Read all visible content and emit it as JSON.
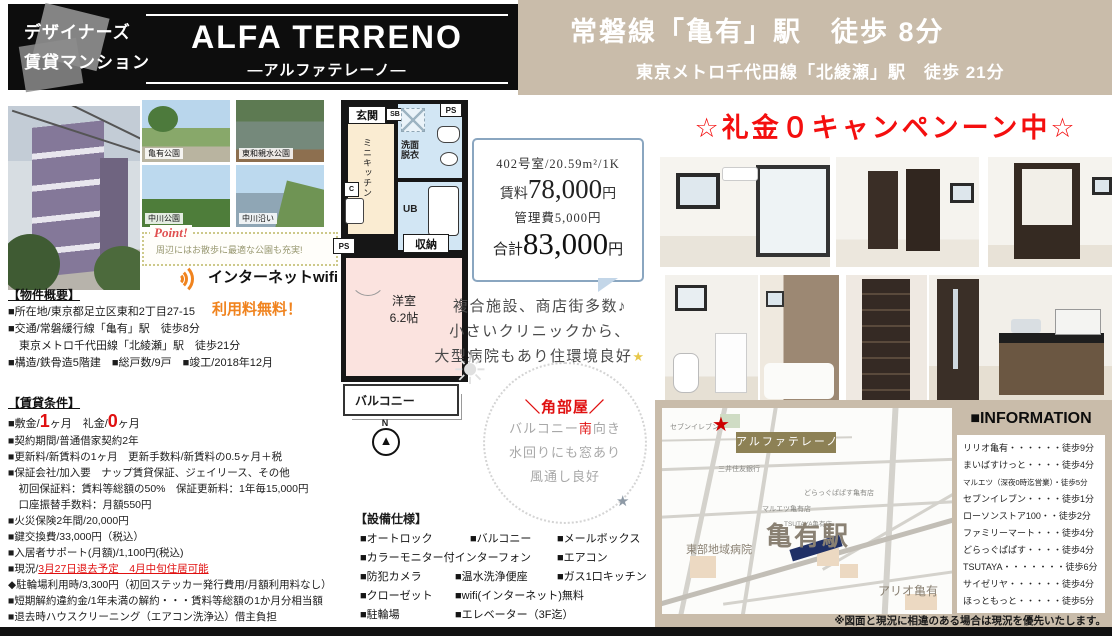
{
  "colors": {
    "accent_red": "#f40f0f",
    "orange": "#f0831e",
    "tan": "#c9bcaa",
    "navy": "#203066",
    "olive": "#8d8155"
  },
  "header": {
    "tagline1": "デザイナーズ",
    "tagline2": "賃貸マンション",
    "building_name": "ALFA TERRENO",
    "building_kana": "―アルファテレーノ―",
    "access_main": "常磐線「亀有」駅　徒歩 8分",
    "access_sub": "東京メトロ千代田線「北綾瀬」駅　徒歩 21分"
  },
  "campaign": "☆礼金０キャンペンーン中☆",
  "photos": {
    "parks": [
      "亀有公園",
      "東和親水公園",
      "中川公園",
      "中川沿い"
    ]
  },
  "point": {
    "label": "Point!",
    "text": "周辺にはお散歩に最適な公園も充実!"
  },
  "wifi": {
    "label": "インターネットwifi",
    "free": "利用料無料！"
  },
  "overview": {
    "title": "【物件概要】",
    "lines": [
      "■所在地/東京都足立区東和2丁目27-15",
      "■交通/常磐緩行線「亀有」駅　徒歩8分",
      "　東京メトロ千代田線「北綾瀬」駅　徒歩21分",
      "■構造/鉄骨造5階建　■総戸数/9戸　■竣工/2018年12月"
    ]
  },
  "terms": {
    "title": "【賃貸条件】",
    "deposit": {
      "p1": "■敷金/",
      "v1": "1",
      "p2": "ヶ月　礼金/",
      "v2": "0",
      "p3": "ヶ月"
    },
    "lines": [
      "■契約期間/普通借家契約2年",
      "■更新料/新賃料の1ヶ月　更新手数料/新賃料の0.5ヶ月＋税",
      "■保証会社/加入要　ナップ賃貸保証、ジェイリース、その他",
      "　初回保証料：賃料等総額の50%　保証更新料：1年毎15,000円",
      "　口座振替手数料：月額550円",
      "■火災保険2年間/20,000円",
      "■鍵交換費/33,000円（税込）",
      "■入居者サポート(月額)/1,100円(税込)"
    ],
    "status_prefix": "■現況/",
    "status_red": "3月27日退去予定　4月中旬住居可能",
    "lines2": [
      "◆駐輪場利用時/3,300円（初回ステッカー発行費用/月額利用料なし）",
      "■短期解約違約金/1年未満の解約・・・賃料等総額の1か月分相当額",
      "■退去時ハウスクリーニング（エアコン洗浄込）借主負担"
    ]
  },
  "floorplan": {
    "genkan": "玄関",
    "sb": "SB",
    "ps1": "PS",
    "ps2": "PS",
    "ps3": "PS",
    "kitchen": "ミニキッチン",
    "senmen1": "洗面",
    "senmen2": "脱衣",
    "ub": "UB",
    "fridge": "C",
    "storage": "収納",
    "room_name": "洋室",
    "room_size": "6.2帖",
    "balcony": "バルコニー",
    "compass_n": "N"
  },
  "price": {
    "unit": "402号室/20.59m²/1K",
    "rent_label": "賃料",
    "rent": "78,000",
    "rent_unit": "円",
    "mgmt": "管理費5,000円",
    "total_label": "合計",
    "total": "83,000",
    "total_unit": "円"
  },
  "environment": {
    "line1": "複合施設、商店街多数♪",
    "line2": "小さいクリニックから、",
    "line3": "大型病院もあり住環境良好",
    "sparkle": "★"
  },
  "corner": {
    "title": "＼角部屋／",
    "l1a": "バルコニー",
    "l1b": "南",
    "l1c": "向き",
    "l2": "水回りにも窓あり",
    "l3": "風通し良好"
  },
  "equipment": {
    "title": "【設備仕様】",
    "rows": [
      [
        "■オートロック",
        "■バルコニー",
        "■メールボックス"
      ],
      [
        "■カラーモニター付インターフォン",
        "■エアコン"
      ],
      [
        "■防犯カメラ",
        "■温水洗浄便座",
        "■ガス1口キッチン"
      ],
      [
        "■クローゼット",
        "■wifi(インターネット)無料"
      ],
      [
        "■駐輪場",
        "■エレベーター（3F迄）"
      ],
      [
        "■敷地内ゴミ置場",
        "■室内洗濯機置き場"
      ]
    ]
  },
  "map": {
    "property": "アルファテレーノ",
    "station": "亀有駅",
    "hospital": "東部地域病院",
    "ario": "アリオ亀有",
    "seven": "セブンイレブン",
    "bank": "三井住友銀行",
    "maruetsu": "マルエツ亀有店",
    "drug": "どらっぐぱぱす亀有店",
    "tsutaya": "TSUTAYA亀有店"
  },
  "info": {
    "title": "■INFORMATION",
    "items": [
      "リリオ亀有・・・・・・徒歩9分",
      "まいばすけっと・・・・徒歩4分",
      "マルエツ（深夜0時迄営業）・徒歩5分",
      "セブンイレブン・・・・徒歩1分",
      "ローソンストア100・・徒歩2分",
      "ファミリーマート・・・徒歩4分",
      "どらっぐぱぱす・・・・徒歩4分",
      "TSUTAYA・・・・・・・徒歩6分",
      "サイゼリヤ・・・・・・徒歩4分",
      "ほっともっと・・・・・徒歩5分"
    ]
  },
  "disclaimer": "※図面と現況に相違のある場合は現況を優先いたします。"
}
